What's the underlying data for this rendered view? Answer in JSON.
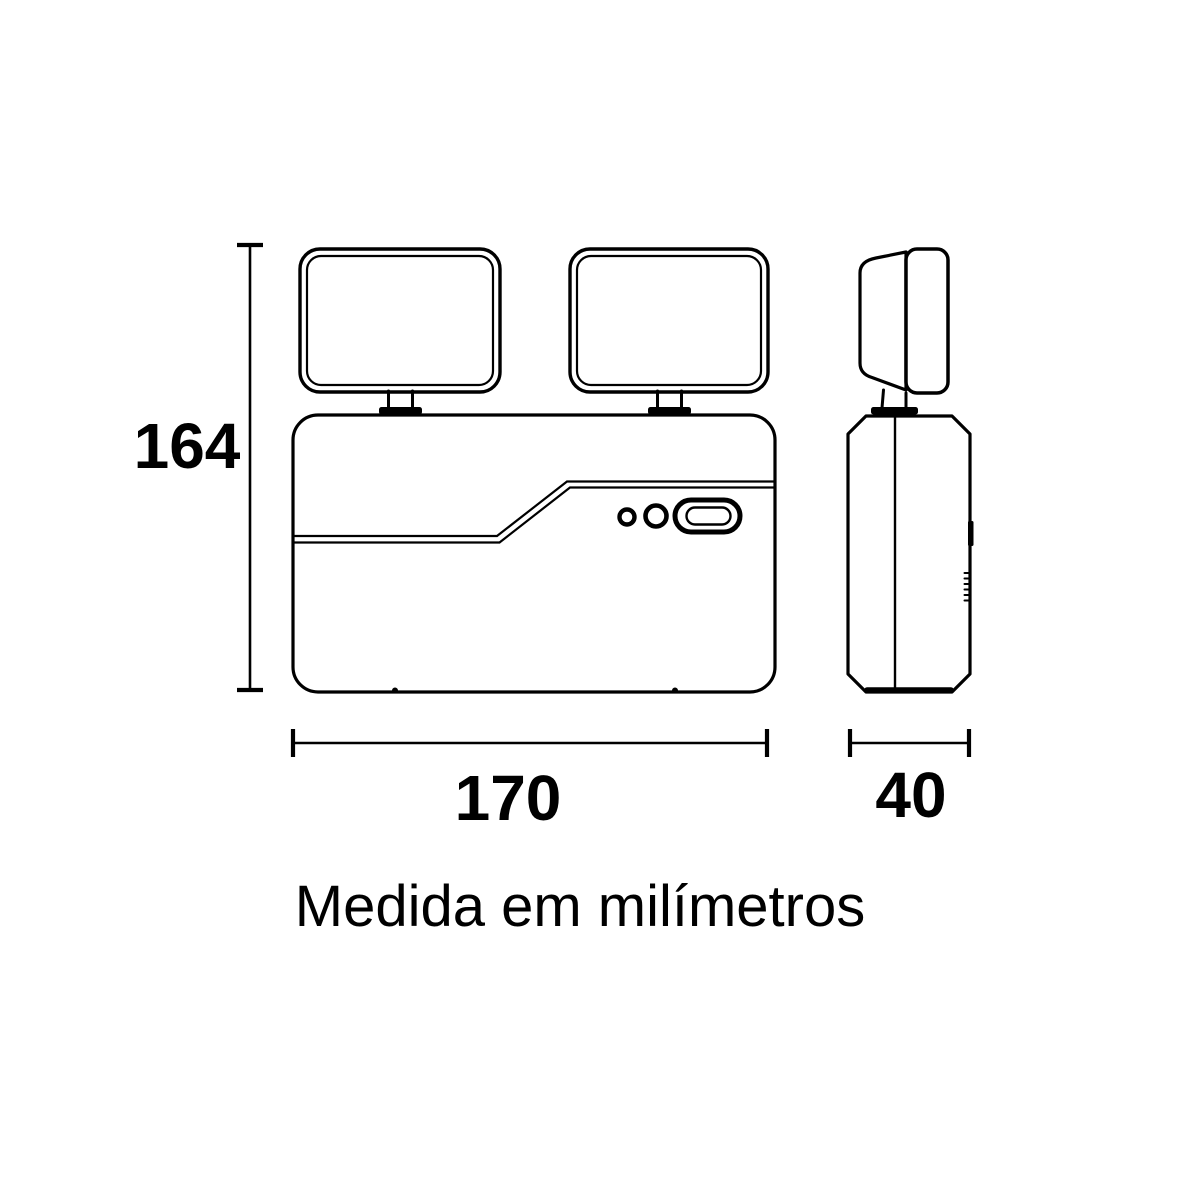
{
  "page": {
    "background_color": "#ffffff",
    "line_color": "#000000"
  },
  "drawing": {
    "caption": "Medida em milímetros",
    "dimensions": {
      "height_mm": "164",
      "width_mm": "170",
      "depth_mm": "40"
    }
  }
}
